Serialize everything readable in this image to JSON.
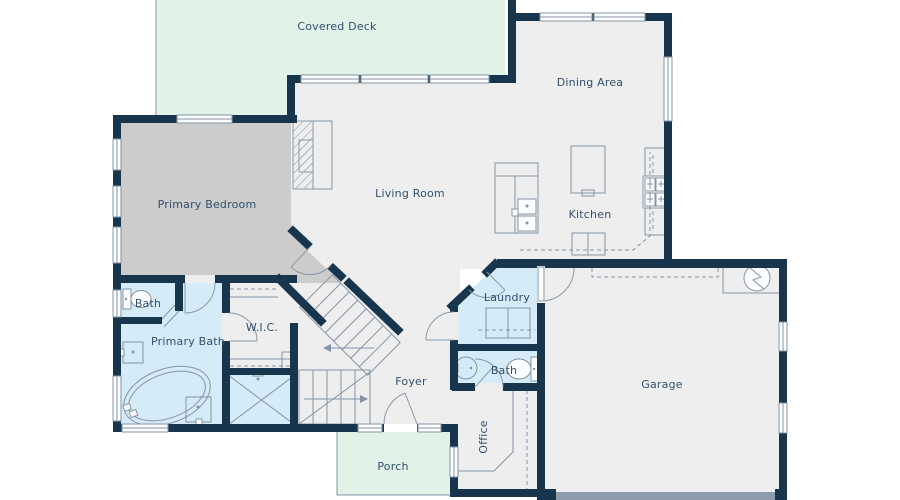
{
  "plan": {
    "type": "residential-floor-plan",
    "rooms": {
      "covered_deck": {
        "label": "Covered Deck"
      },
      "dining_area": {
        "label": "Dining Area"
      },
      "primary_bedroom": {
        "label": "Primary Bedroom"
      },
      "living_room": {
        "label": "Living Room"
      },
      "kitchen": {
        "label": "Kitchen"
      },
      "bath_primary_wc": {
        "label": "Bath"
      },
      "primary_bath": {
        "label": "Primary Bath"
      },
      "wic": {
        "label": "W.I.C."
      },
      "laundry": {
        "label": "Laundry"
      },
      "bath_hall": {
        "label": "Bath"
      },
      "foyer": {
        "label": "Foyer"
      },
      "office": {
        "label": "Office"
      },
      "garage": {
        "label": "Garage"
      },
      "porch": {
        "label": "Porch"
      }
    },
    "fixtures": [
      "fireplace-icon",
      "staircase-icon",
      "washer-dryer-icon",
      "water-heater-icon",
      "range-icon",
      "kitchen-island-icon",
      "kitchen-sink-icon",
      "bathtub-icon",
      "shower-icon",
      "toilet-icon",
      "vanity-sink-icon",
      "round-sink-icon",
      "desk-icon",
      "garage-door-icon",
      "door-swing-icon",
      "window-icon"
    ],
    "colors": {
      "wall": "#18354e",
      "interior_floor": "#eeeeef",
      "bedroom_floor": "#cbcccb",
      "bath_floor": "#d5ebf7",
      "outdoor_floor": "#e1f2e8",
      "garage_door": "#8d9dad",
      "fixture_line": "#8494a4",
      "label_text": "#31506e",
      "background": "#ffffff"
    }
  }
}
